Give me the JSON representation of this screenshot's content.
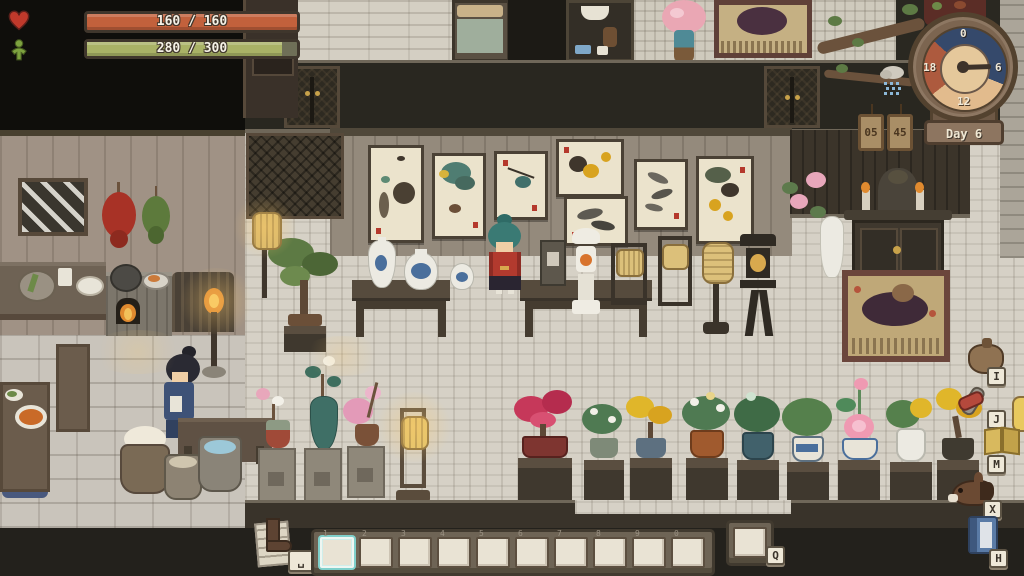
{
  "hud": {
    "health_bar": {
      "icon": "heart-icon",
      "value_text": "160 / 160",
      "fill_percent": 100,
      "fill_color": "#c2613c"
    },
    "stamina_bar": {
      "icon": "stamina-figure-icon",
      "value_text": "280 / 300",
      "fill_percent": 93,
      "fill_color": "#a9b266"
    },
    "clock": {
      "day_label": "Day 6",
      "ticks": {
        "top": "0",
        "right": "6",
        "bottom": "12",
        "left": "18"
      },
      "time_plaques": [
        "05",
        "45"
      ],
      "hand_angle_deg": 88,
      "weather_icon": "snow-cloud-icon",
      "segment_colors": {
        "night": "#35496b",
        "day": "#e2bb8d",
        "dusk": "#ad5a3e"
      }
    }
  },
  "side_menu": {
    "buttons": [
      {
        "id": "inventory",
        "icon": "bag-icon",
        "key": "I"
      },
      {
        "id": "wardrobe",
        "icon": "outfit-icon",
        "key": "J"
      },
      {
        "id": "map",
        "icon": "map-book-icon",
        "key": "M"
      },
      {
        "id": "horse",
        "icon": "horse-icon",
        "key": "X"
      },
      {
        "id": "handbook",
        "icon": "handbook-icon",
        "key": "H"
      }
    ]
  },
  "hotbar": {
    "slot_keys": [
      "1",
      "2",
      "3",
      "4",
      "5",
      "6",
      "7",
      "8",
      "9",
      "0"
    ],
    "selected_slot": "1",
    "extra_slot_key": "Q",
    "walk_toggle_key": "␣",
    "walk_toggle_icon": "boot-icon"
  }
}
